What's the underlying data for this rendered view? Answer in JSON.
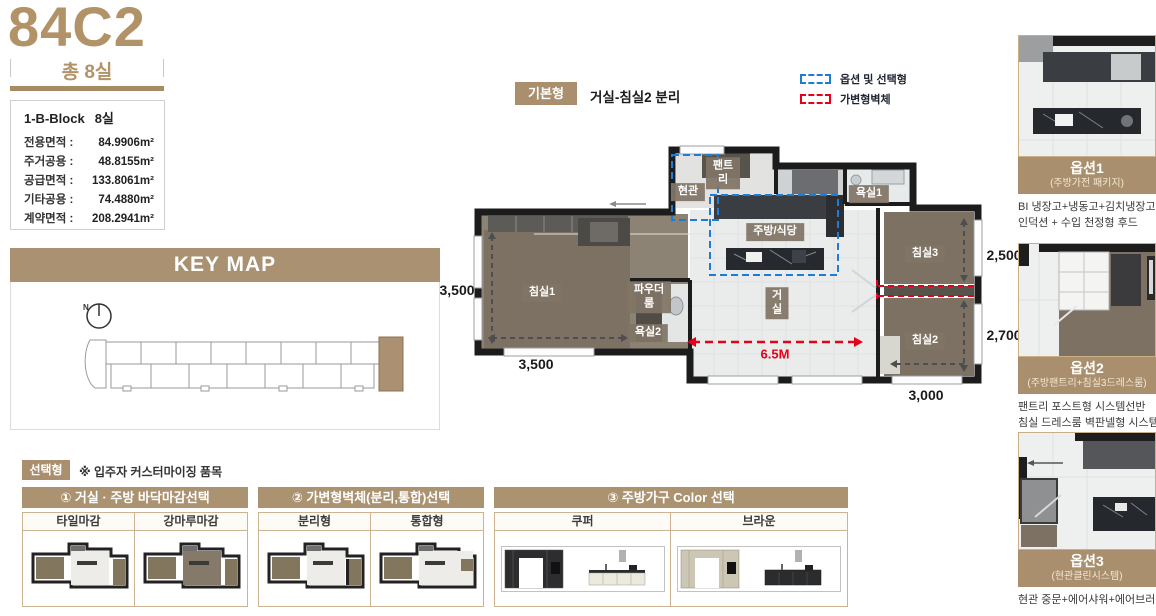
{
  "unit": {
    "code": "84C2",
    "total_rooms": "총 8실"
  },
  "info_box": {
    "block_label": "1-B-Block",
    "block_rooms": "8실",
    "rows": [
      {
        "label": "전용면적 :",
        "value": "84.9906m²"
      },
      {
        "label": "주거공용 :",
        "value": "48.8155m²"
      },
      {
        "label": "공급면적 :",
        "value": "133.8061m²"
      },
      {
        "label": "기타공용 :",
        "value": "74.4880m²"
      },
      {
        "label": "계약면적 :",
        "value": "208.2941m²"
      }
    ]
  },
  "key_map": {
    "title": "KEY MAP",
    "north_label": "N"
  },
  "plan_header": {
    "type_badge": "기본형",
    "type_desc": "거실-침실2 분리",
    "legend": [
      {
        "label": "옵션 및 선택형",
        "color": "#1e7cd7"
      },
      {
        "label": "가변형벽체",
        "color": "#e60019"
      }
    ]
  },
  "floor_plan": {
    "rooms": [
      {
        "label": "현관"
      },
      {
        "label": "팬트리"
      },
      {
        "label": "욕실1"
      },
      {
        "label": "주방/식당"
      },
      {
        "label": "침실1"
      },
      {
        "label": "파우더룸"
      },
      {
        "label": "욕실2"
      },
      {
        "label": "거실"
      },
      {
        "label": "침실3"
      },
      {
        "label": "침실2"
      }
    ],
    "dimensions": {
      "left": "3,500",
      "bottom_left": "3,500",
      "living_width": "6.5M",
      "bottom_right": "3,000",
      "right_top": "2,500",
      "right_bottom": "2,700"
    }
  },
  "options": [
    {
      "name": "옵션1",
      "caption": "(주방가전 패키지)",
      "desc_lines": [
        "BI 냉장고+냉동고+김치냉장고+키큰장",
        "인덕션 + 수입 천정형 후드"
      ]
    },
    {
      "name": "옵션2",
      "caption": "(주방팬트리+침실3드레스룸)",
      "desc_lines": [
        "팬트리 포스트형 시스템선반",
        "침실 드레스룸 벽판넬형 시스템선반"
      ]
    },
    {
      "name": "옵션3",
      "caption": "(현관클린시스템)",
      "desc_lines": [
        "현관 중문+에어샤워+에어브러쉬"
      ]
    }
  ],
  "select_section": {
    "badge": "선택형",
    "note": "※ 입주자 커스터마이징 품목",
    "panels": [
      {
        "title": "① 거실 · 주방 바닥마감선택",
        "columns": [
          "타일마감",
          "강마루마감"
        ]
      },
      {
        "title": "② 가변형벽체(분리,통합)선택",
        "columns": [
          "분리형",
          "통합형"
        ]
      },
      {
        "title": "③ 주방가구 Color 선택",
        "columns": [
          "쿠퍼",
          "브라운"
        ]
      }
    ]
  },
  "colors": {
    "accent_tan": "#ab9271",
    "badge_tan": "#a98f6d",
    "legend_blue": "#1e7cd7",
    "legend_red": "#e60019",
    "wall": "#1d1d1d",
    "wood_floor": "#7c7163",
    "tile": "#eaeceb"
  }
}
